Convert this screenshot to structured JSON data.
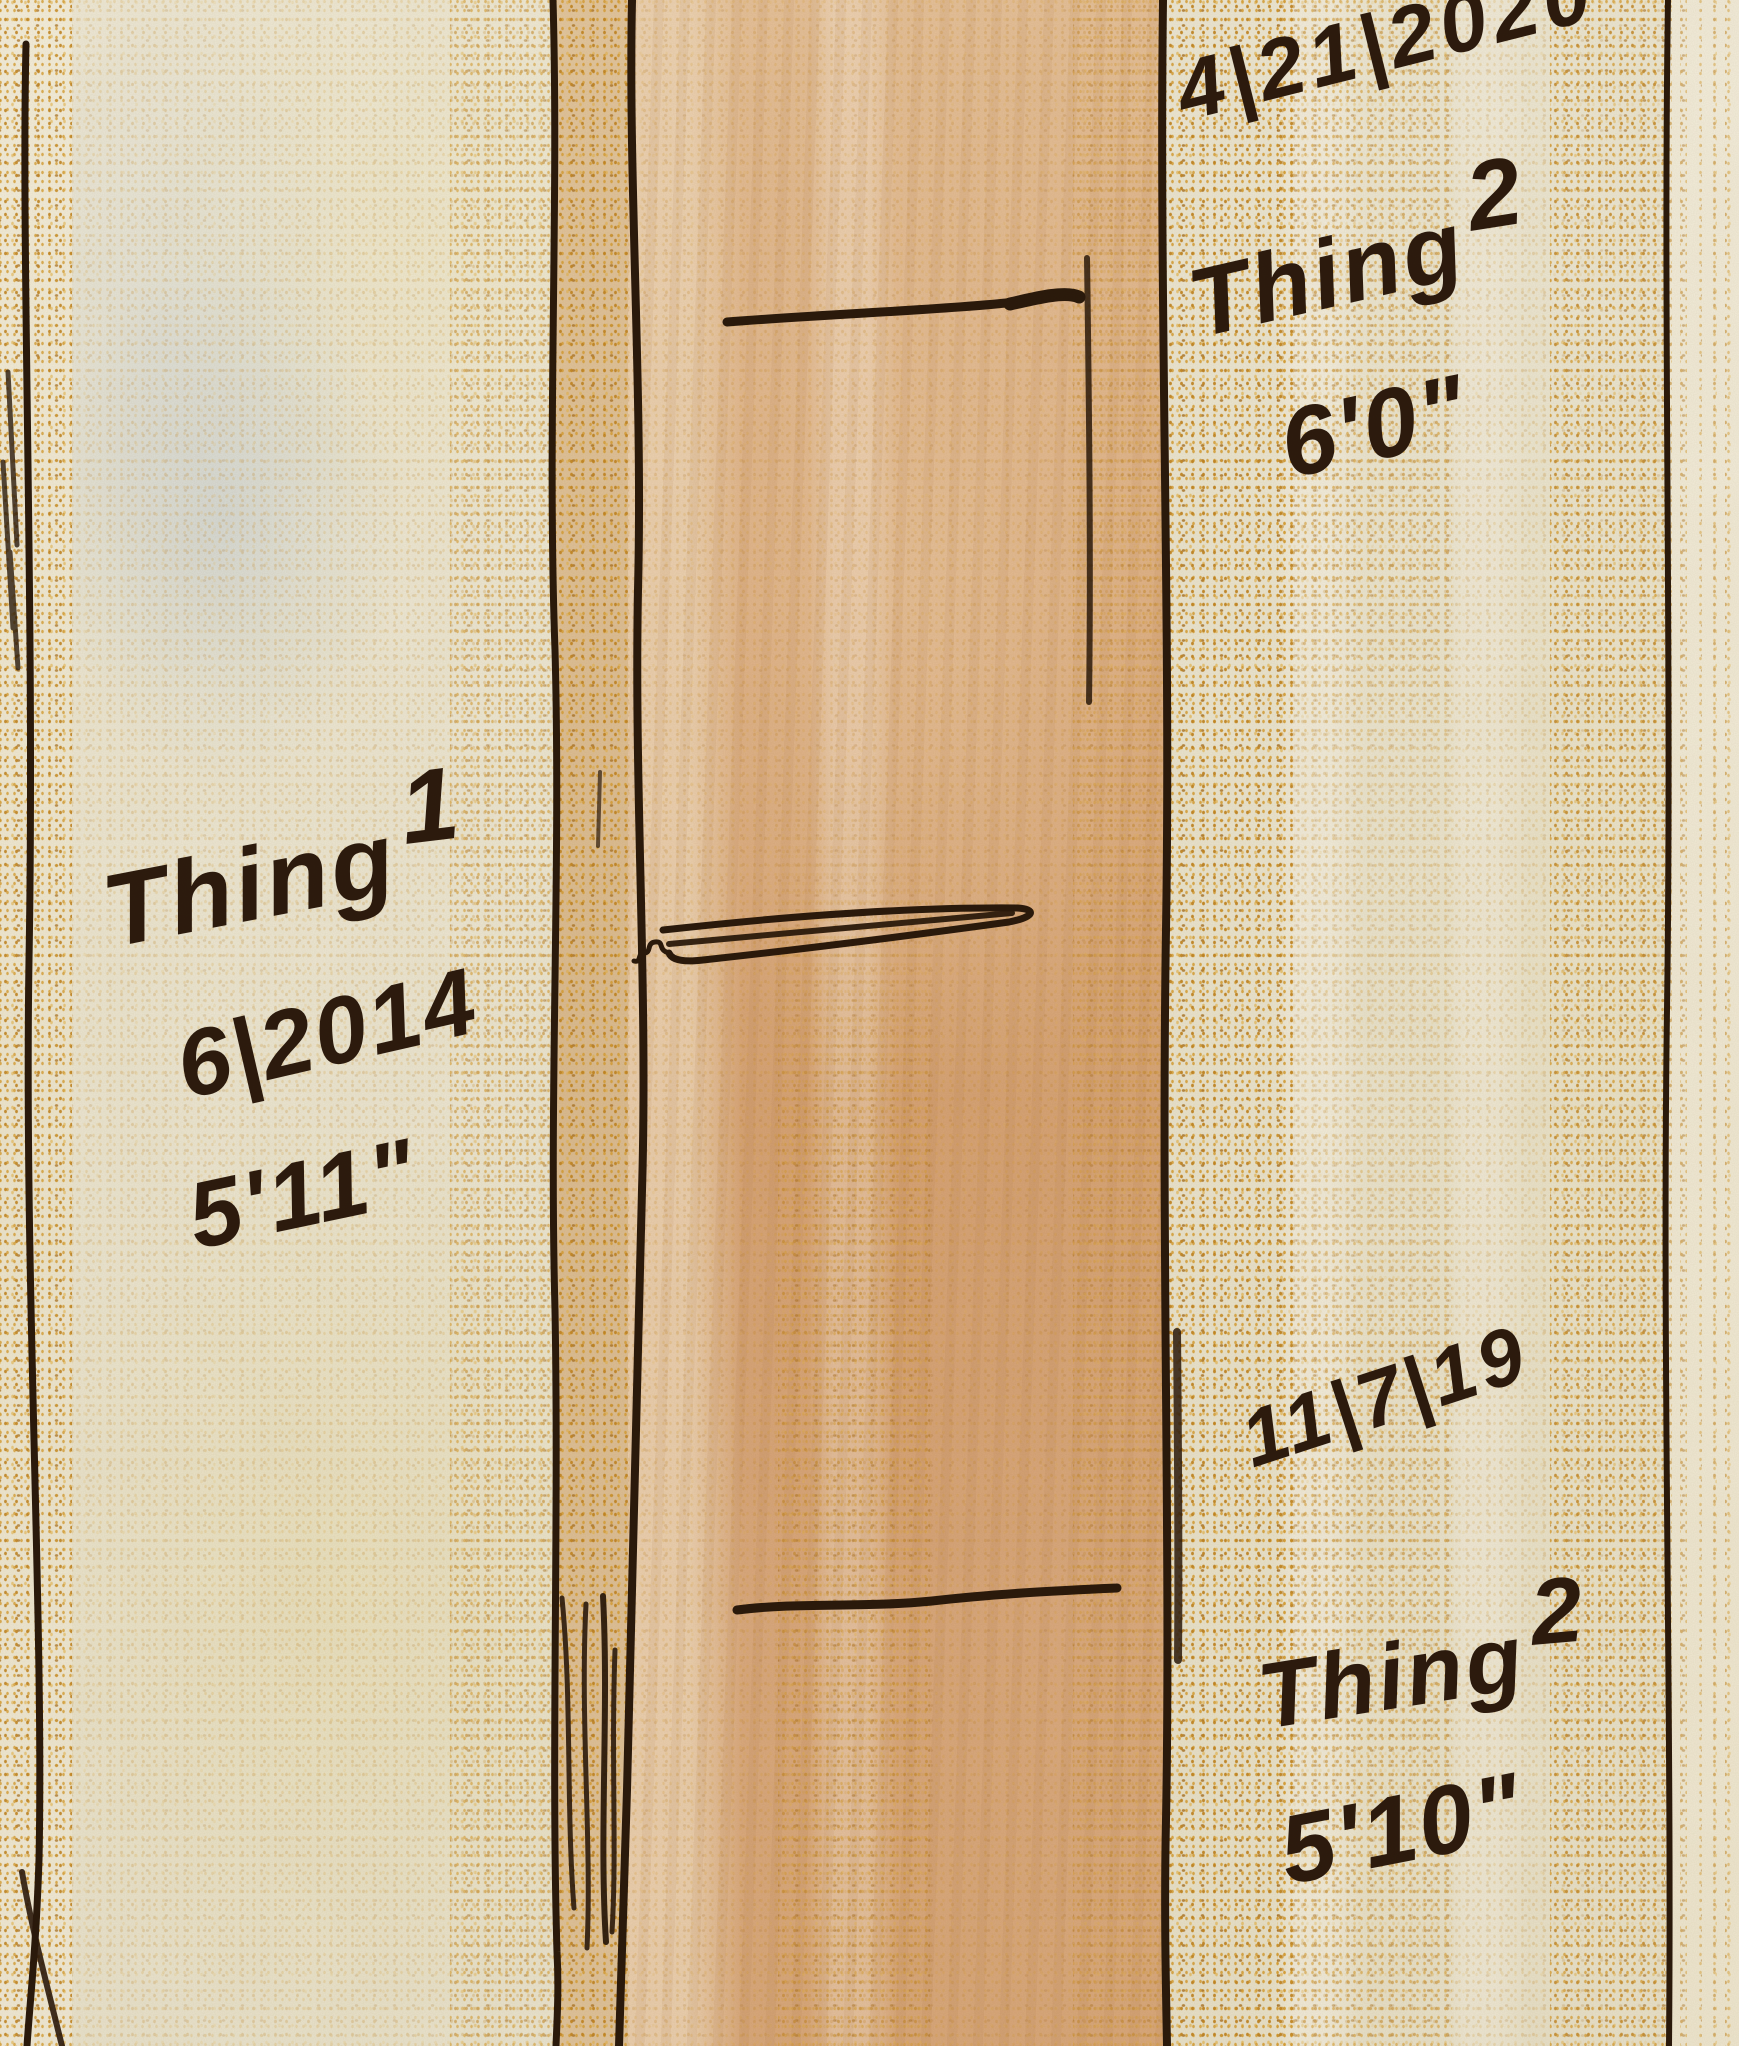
{
  "artwork": {
    "type": "watercolor and ink sketch",
    "subject": "door frame height growth chart",
    "colors": {
      "paper_cream": "#ece7d4",
      "door_frame_tan": "#dcab7e",
      "crayon_gold": "#c98f2a",
      "ink_dark_brown": "#2b1a0b",
      "handwriting": "#2d1b0d"
    },
    "annotations": {
      "top_right": {
        "date": "4|21|2020",
        "name_parts": [
          "Thing",
          "2"
        ],
        "height": "6'0\""
      },
      "left": {
        "name_parts": [
          "Thing",
          "1"
        ],
        "date": "6|2014",
        "height": "5'11\""
      },
      "bottom_right": {
        "date": "11|7|19",
        "name_parts": [
          "Thing",
          "2"
        ],
        "height": "5'10\""
      }
    },
    "measurements": [
      {
        "person": "Thing 2",
        "date": "4|21|2020",
        "height": "6'0\"",
        "mark_position": "top"
      },
      {
        "person": "Thing 1",
        "date": "6|2014",
        "height": "5'11\"",
        "mark_position": "middle"
      },
      {
        "person": "Thing 2",
        "date": "11|7|19",
        "height": "5'10\"",
        "mark_position": "bottom"
      }
    ]
  }
}
